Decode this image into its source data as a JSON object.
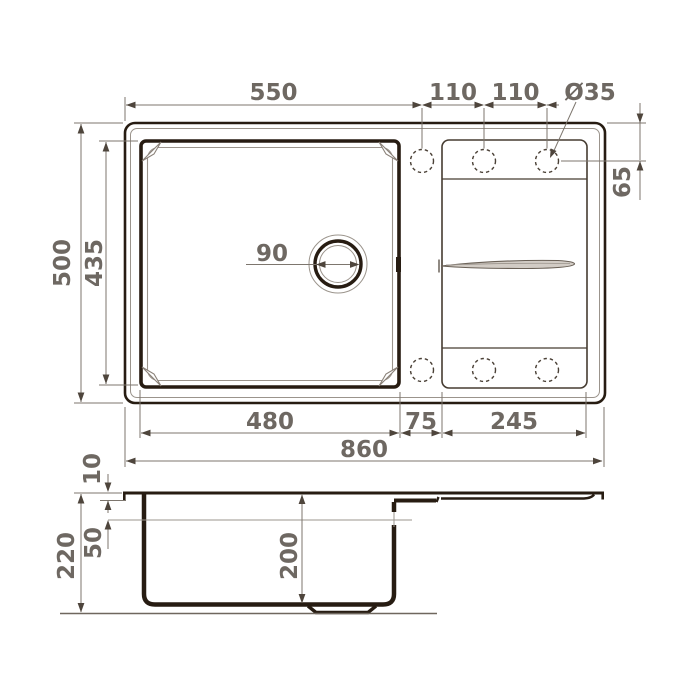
{
  "drawing_title": "sink-dimension-drawing",
  "colors": {
    "background": "#ffffff",
    "outline_dark": "#271c12",
    "outline_medium": "#463c31",
    "outline_thin": "#9b948c",
    "dimension_line": "#7d766e",
    "dimension_text": "#6e6862"
  },
  "labels": {
    "top": {
      "bowl_width": "550",
      "hole_pitch_a": "110",
      "hole_pitch_b": "110",
      "hole_diameter": "Ø35",
      "hole_offset": "65"
    },
    "plan": {
      "overall_depth": "500",
      "bowl_depth": "435",
      "drain_diameter": "90"
    },
    "bottom": {
      "bowl_width": "480",
      "web_width": "75",
      "drainboard_width": "245",
      "overall_width": "860"
    },
    "side": {
      "rim_height": "10",
      "total_height": "220",
      "upper_height": "50",
      "bowl_height": "200"
    }
  }
}
